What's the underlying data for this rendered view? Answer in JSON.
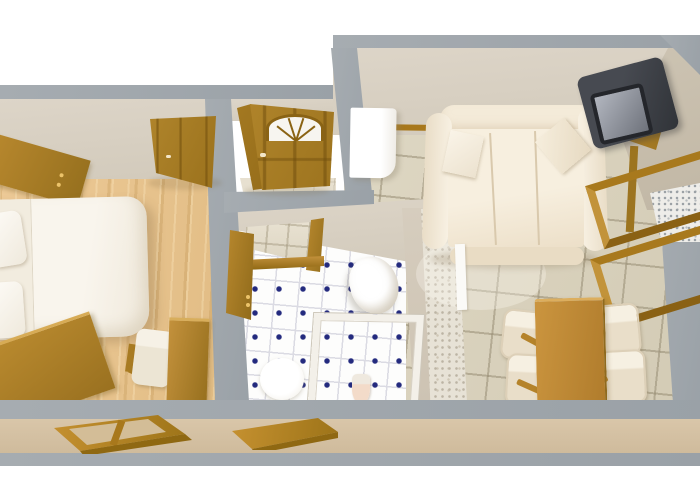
{
  "image": {
    "type": "3d-floor-plan-render",
    "description": "Bird's-eye 3D rendering of a one-bedroom apartment with cut-away gray walls on a white background",
    "background": "#ffffff"
  },
  "rooms": [
    {
      "name": "bedroom",
      "position": "left",
      "floor": "light wood planks",
      "furniture": [
        "double bed with two pillows",
        "wardrobe along left wall",
        "open interior door",
        "corner writing desk",
        "white chair",
        "wooden dresser"
      ]
    },
    {
      "name": "entry-hall",
      "position": "top-center",
      "floor": "beige tile",
      "features": [
        "front door with arched fanlight window",
        "paneled wooden door leaf"
      ]
    },
    {
      "name": "bathroom",
      "position": "bottom-center",
      "floor": "white tile with blue diamond accents",
      "furniture": [
        "marble vanity counter with wood edge",
        "tall wooden cabinet",
        "corner wash basin",
        "shower stall",
        "toilet"
      ]
    },
    {
      "name": "living-room",
      "position": "right",
      "floor": "beige ceramic tile",
      "furniture": [
        "cream three-seat sofa with two throw pillows",
        "CRT television on wooden corner stand",
        "white cabinet",
        "wooden dining table",
        "four cream dining chairs",
        "two wooden wall frames on right wall"
      ]
    }
  ],
  "exterior": {
    "south_wall": [
      "wide two-pane window frame below bedroom",
      "small window frame below bathroom"
    ],
    "finish": "gray concrete band with tan stripe"
  },
  "palette": {
    "wall_gray": "#a1a7ac",
    "wall_beige": "#d9d1c3",
    "wall_taupe": "#c8bead",
    "wood_brown": "#a87e26",
    "wood_floor": "#e9c794",
    "tile_beige": "#d9d2be",
    "bath_tile_white": "#fdfdfc",
    "bath_dot_blue": "#232a7e",
    "sofa_cream": "#f4ebd9",
    "tv_dark": "#3e4147",
    "stripe_tan": "#d5c1a3"
  }
}
